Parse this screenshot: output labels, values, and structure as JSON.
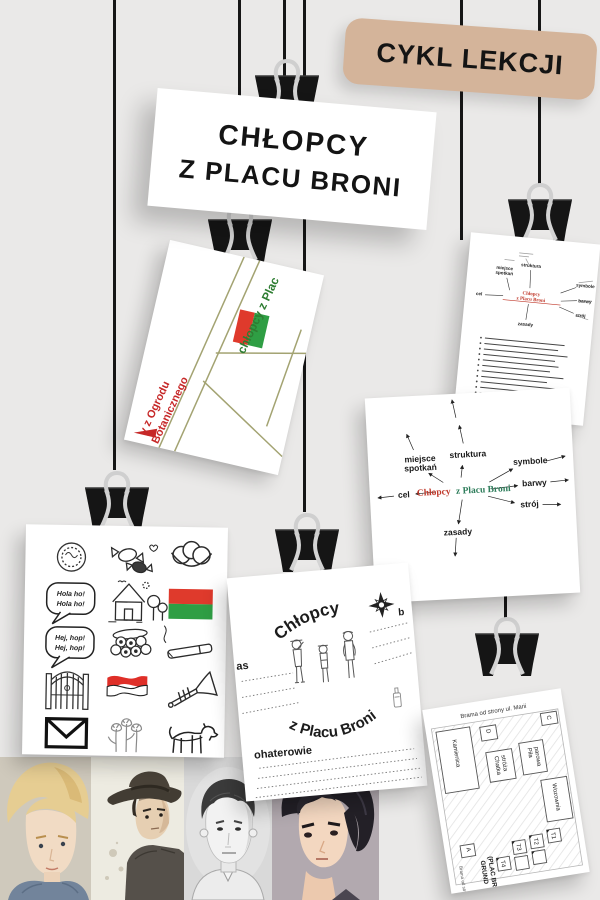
{
  "badge": {
    "label": "CYKL LEKCJI",
    "bg": "#d4b49a"
  },
  "title": {
    "line1": "CHŁOPCY",
    "line2": "Z PLACU BRONI"
  },
  "mapsketch": {
    "green": "chłopcy z Plac",
    "red1": "y z Ogrodu",
    "red2": "Botanicznego",
    "flag_colors": [
      "#df3a2c",
      "#2f9e44"
    ]
  },
  "mindmap": {
    "center1": "Chłopcy",
    "center2": "z Placu Broni",
    "cel": "cel",
    "miejsce": "miejsce",
    "spotkan": "spotkań",
    "struktura": "struktura",
    "symbole": "symbole",
    "barwy": "barwy",
    "stroj": "strój",
    "zasady": "zasady"
  },
  "star": {
    "center_red": "Chłopcy",
    "center_green": "z Placu Broni",
    "cel": "cel",
    "miejsce": "miejsce",
    "spotkan": "spotkań",
    "struktura": "struktura",
    "symbole": "symbole",
    "barwy": "barwy",
    "stroj": "strój",
    "zasady": "zasady"
  },
  "iconscard": {
    "speech1a": "Hola ho!",
    "speech1b": "Hola ho!",
    "speech2a": "Hej, hop!",
    "speech2b": "Hej, hop!",
    "icons": [
      "medal",
      "candies",
      "eggs-nest",
      "speech-hola",
      "house",
      "flag-red-green",
      "speech-hej",
      "woodpile",
      "cigarette",
      "gate",
      "flag-red-white",
      "trumpet",
      "envelope",
      "tulips",
      "dog"
    ]
  },
  "worksheet": {
    "arc_top": "Chłopcy",
    "arc_bottom": "z Placu Broni",
    "czas": "as",
    "bohaterowie": "ohaterowie",
    "b": "b"
  },
  "plan": {
    "gate_top": "Brama od strony ul. Marii",
    "kamienica": "Kamienica",
    "chatka1": "Chatka",
    "chatka2": "stróża",
    "pila1": "Piła",
    "pila2": "parowa",
    "wozownia": "Wozownia",
    "d": "D",
    "c": "C",
    "a": "A",
    "t1": "T1",
    "t2": "T2",
    "t3": "T3",
    "t4": "T4",
    "grund1": "GRUND",
    "grund2": "(PLAC BRONI)",
    "gate_bottom": "Brama od strony"
  },
  "portraits": [
    {
      "name": "blond-boy-portrait"
    },
    {
      "name": "boy-with-hat-portrait"
    },
    {
      "name": "sketch-boy-portrait"
    },
    {
      "name": "dark-haired-boy-portrait"
    }
  ],
  "colors": {
    "background": "#eae9e8",
    "badge_bg": "#d4b49a",
    "red": "#c62828",
    "flag_red": "#df3a2c",
    "flag_green": "#2f9e44",
    "teal_green": "#2e7d5b",
    "olive": "#a3a372",
    "string": "#161616"
  }
}
